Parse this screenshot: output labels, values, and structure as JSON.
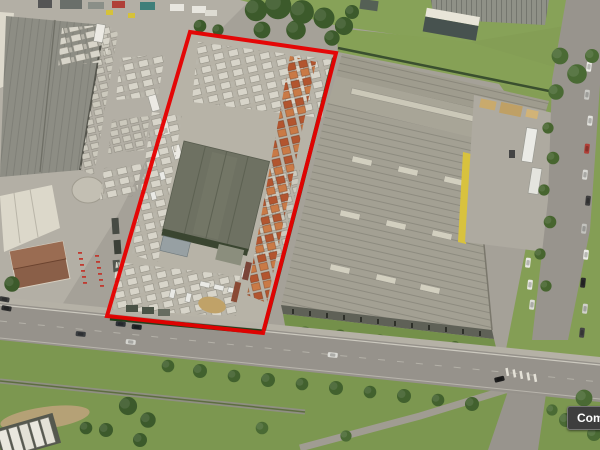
{
  "map": {
    "view": "aerial-oblique-birds-eye",
    "boundary": {
      "points": "190,32 336,53 263,333 107,316",
      "color": "#e60000",
      "width": "4"
    },
    "tooltip": {
      "label": "Comme",
      "bg": "#3e3e3e",
      "text_color": "#ffffff"
    },
    "palette": {
      "asphalt": "#a5a198",
      "concrete": "#b3afa5",
      "parcel_gravel": "#b7b3a7",
      "grass": "#7c9750",
      "warehouse_roof_right": "#a3a093",
      "warehouse_roof_parcel": "#6e7162",
      "warehouse_roof_left": "#8d8d84",
      "accent_yellow": "#d8c23e",
      "hedge_green": "#2c4623",
      "house_roof": "#8a5f48"
    }
  }
}
